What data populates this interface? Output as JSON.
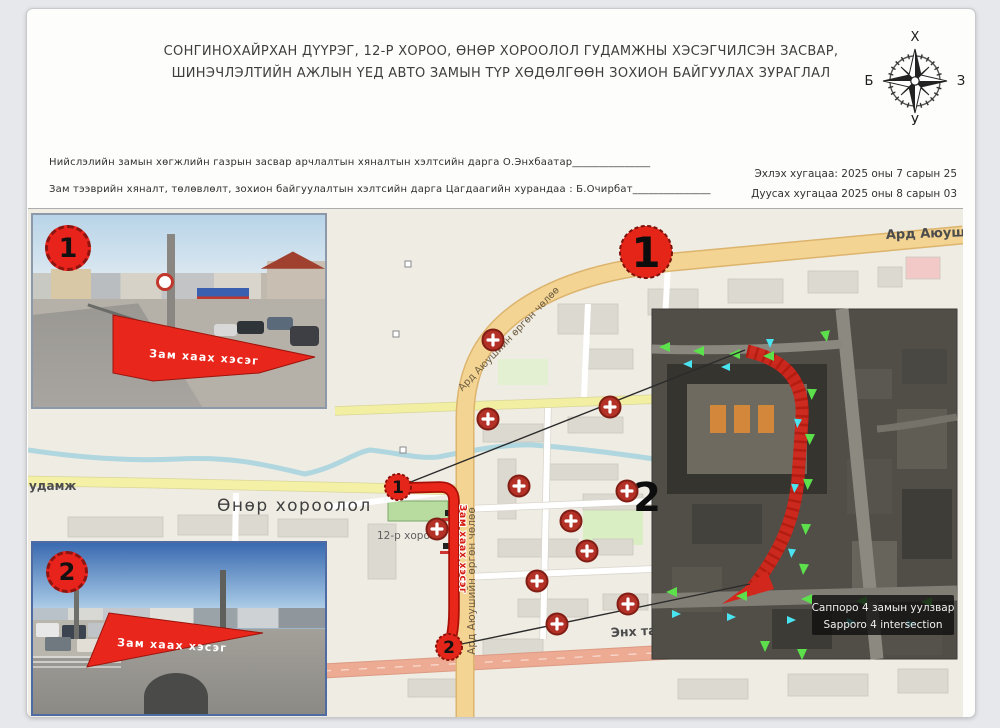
{
  "document": {
    "title": "СОНГИНОХАЙРХАН ДҮҮРЭГ, 12-Р ХОРОО, ӨНӨР ХОРООЛОЛ ГУДАМЖНЫ ХЭСЭГЧИЛСЭН ЗАСВАР, ШИНЭЧЛЭЛТИЙН АЖЛЫН ҮЕД АВТО ЗАМЫН ТҮР ХӨДӨЛГӨӨН ЗОХИОН БАЙГУУЛАХ ЗУРАГЛАЛ",
    "signature_line1": "Нийслэлийн замын хөгжлийн газрын засвар арчлалтын хяналтын хэлтсийн дарга О.Энхбаатар_______________",
    "signature_line2": "Зам тээврийн хяналт, төлөвлөлт, зохион байгуулалтын хэлтсийн дарга Цагдаагийн хурандаа : Б.Очирбат_______________",
    "start_date": "Эхлэх хугацаа: 2025 оны 7 сарын 25",
    "end_date": "Дуусах хугацаа 2025 оны 8 сарын 03"
  },
  "compass": {
    "north": "Х",
    "south": "У",
    "east": "З",
    "west": "Б"
  },
  "photos": [
    {
      "number": "1",
      "arrow_label": "Зам хаах хэсэг"
    },
    {
      "number": "2",
      "arrow_label": "Зам хаах хэсэг"
    }
  ],
  "map": {
    "street_ard_ayush": "Ард Аюуши",
    "street_avenue_curved": "Ард Аюушийн өргөн чөлөө",
    "street_avenue_vertical": "Ард Аюушийн өргөн чөлөө",
    "street_gudamj": "удамж",
    "street_enkh": "Энх та",
    "district_label": "Өнөр хороолол",
    "khoroo_label": "12-р хороо",
    "route_label": "Зам хаах хэсэг",
    "big_badge_1": "1",
    "map_badge_2": "2",
    "point_start": "1",
    "point_end": "2",
    "colors": {
      "route_red": "#e0241b",
      "road_orange": "#f3d492",
      "road_yellow": "#f2efa2",
      "road_salmon": "#eeab93",
      "marker_red": "#b33127"
    }
  },
  "satellite": {
    "caption_mn": "Саппоро 4 замын уулзвар",
    "caption_en": "Sapporo 4 intersection"
  }
}
